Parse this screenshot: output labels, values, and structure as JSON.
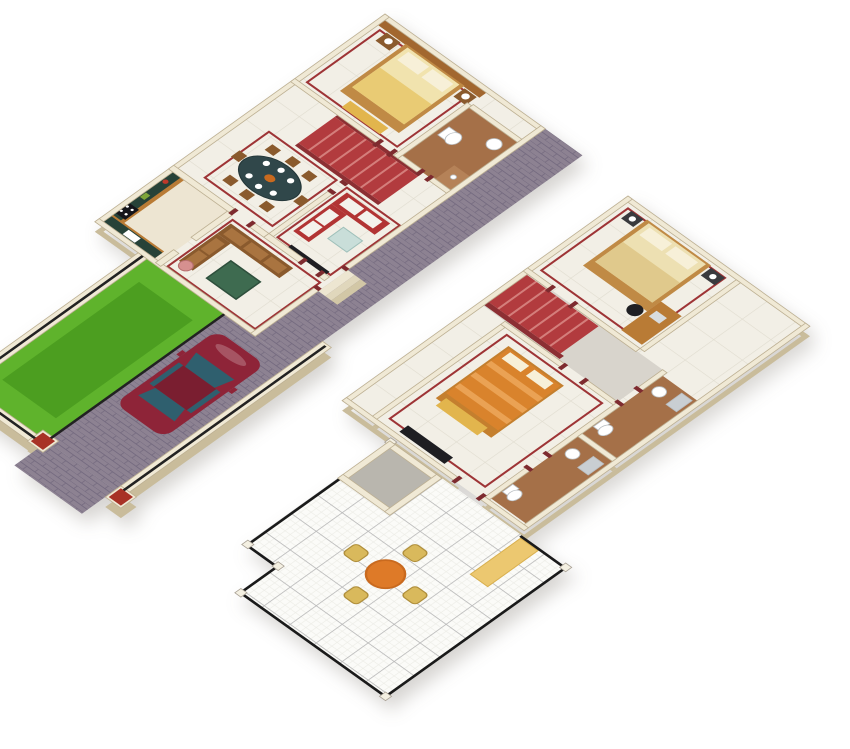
{
  "scene": {
    "type": "3d-isometric-two-storey-floor-plan",
    "background": "#FFFFFF",
    "floors": [
      {
        "id": "ground-floor",
        "position": "top-left",
        "rooms": [
          "master-bedroom",
          "attached-bathroom",
          "staircase",
          "dining-room",
          "living-room",
          "kitchen",
          "sitting-room",
          "entrance-porch"
        ],
        "outdoor": [
          "garden-lawn",
          "paved-walkway",
          "driveway",
          "boundary-wall",
          "gate-posts",
          "parked-car"
        ]
      },
      {
        "id": "upper-floor",
        "position": "bottom-right",
        "rooms": [
          "bedroom-2",
          "bedroom-3",
          "bathroom-1",
          "bathroom-2",
          "staircase",
          "landing-hall",
          "duct-shaft"
        ],
        "outdoor": [
          "roof-terrace",
          "terrace-railing",
          "patio-table-set",
          "sunshade-ledge"
        ]
      }
    ]
  },
  "colors": {
    "wall_top": "#F0E9D5",
    "wall_side": "#C9BC9B",
    "wall_stroke": "#BDB093",
    "floor_tile": "#F2EFE6",
    "grout": "#E0DCCF",
    "kitchen_floor": "#EDE5D2",
    "bath_floor": "#A57048",
    "bath_floor_light": "#B58258",
    "accent_wall_brown": "#A2672F",
    "bed_cream": "#F1E3AE",
    "blanket_gold": "#E9CB74",
    "pillow": "#F7F0D8",
    "wood_dark": "#8A5A2D",
    "wood_mid": "#B97B35",
    "wood_light": "#C08A45",
    "cushion_tan": "#A97440",
    "bench_yellow": "#E2B54D",
    "stair_red": "#B23B3E",
    "stair_stripe": "#D47E7B",
    "stair_wall": "#8C2F33",
    "trim_red": "#9E3436",
    "sofa_red": "#B23434",
    "cushion_white": "#F4F2EC",
    "dining_table": "#30474A",
    "glass_table": "#C9DED9",
    "counter_top": "#274238",
    "appliance_black": "#15151A",
    "lawn": "#5FB32C",
    "lawn_dark": "#4C9E20",
    "paver": "#8D8292",
    "paver_line": "#756B80",
    "fence_black": "#222222",
    "car_body": "#8E2438",
    "car_roof": "#7A1E30",
    "car_glass": "#2F5F6E",
    "terrace_tile": "#FBFBF8",
    "terrace_line": "#B9B9B9",
    "terrace_minor": "#ECECE6",
    "railing": "#1A1A1A",
    "post_white": "#F4F0E2",
    "patio_table": "#DE7A28",
    "patio_table_rim": "#C96A1F",
    "wicker": "#D9B95C",
    "wicker_dark": "#B08F3C",
    "bed_orange": "#D9832C",
    "bed_orange_light": "#EAA254",
    "bed2_cream": "#EDE0B2",
    "bed2_blanket": "#E0C98C",
    "gray_floor": "#D8D4CC",
    "shaft_floor": "#B9B6AE",
    "bath_wall": "#DCDCDA",
    "sunshade": "#ECC870",
    "sunshade_stroke": "#D9B04F",
    "tv_black": "#1E1E22",
    "door_frame": "#7E2B2F",
    "gate_cap": "#A83226",
    "window_dark": "#2A2A2E",
    "fixture_white": "#FFFFFF"
  }
}
